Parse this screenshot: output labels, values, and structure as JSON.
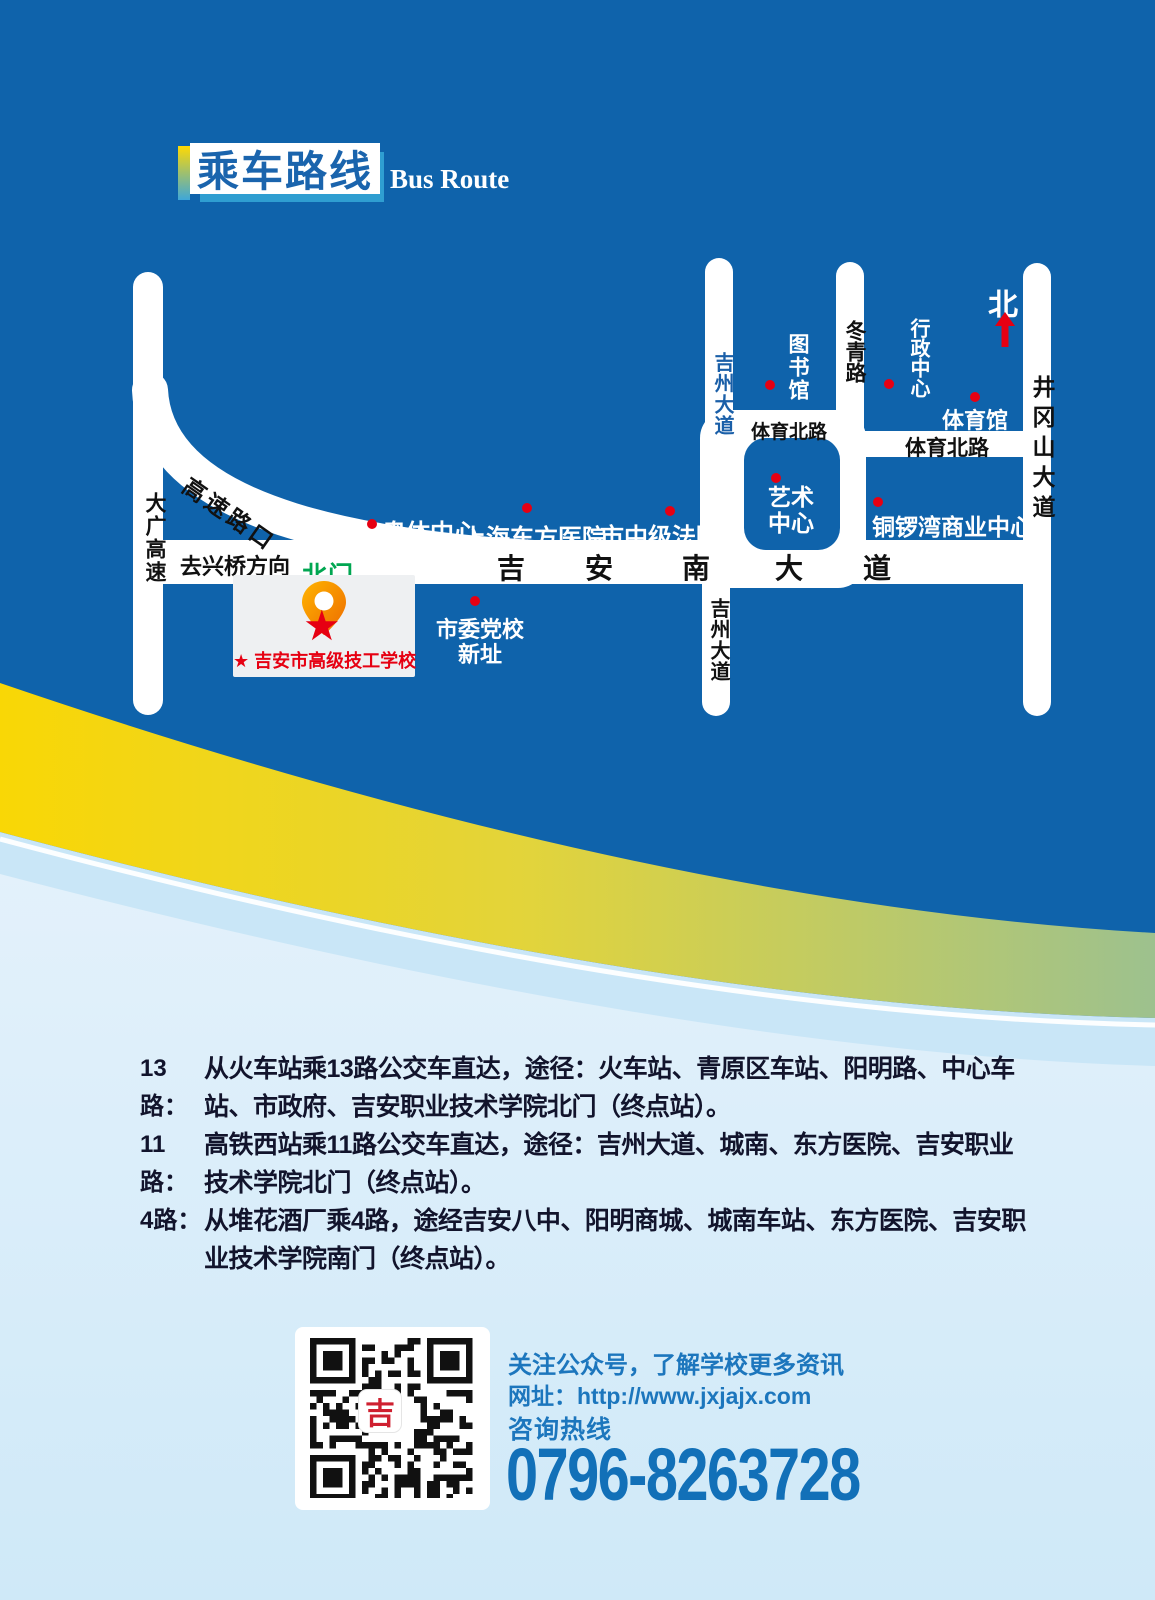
{
  "header": {
    "title": "乘车路线",
    "subtitle": "Bus Route"
  },
  "map": {
    "north_label": "北",
    "roads": {
      "daguang_expwy": "大广高速",
      "expwy_exit": "高速路口",
      "to_xingqiao": "去兴桥方向",
      "north_gate": "北门",
      "jian_south_ave_chars": [
        "吉",
        "安",
        "南",
        "大",
        "道"
      ],
      "jizhou_ave_north": "吉州大道",
      "jizhou_ave_south": "吉州大道",
      "dongqing_rd": "冬青路",
      "tiyu_north_rd_west": "体育北路",
      "tiyu_north_rd_east": "体育北路",
      "jinggangshan_ave": "井冈山大道"
    },
    "landmarks": {
      "aoti_center": "奥体中心",
      "shanghai_dongfang_hospital": "上海东方医院",
      "intermediate_court": "市中级法院",
      "library": "图书馆",
      "art_center": "艺术中心",
      "admin_center": "行政中心",
      "gymnasium": "体育馆",
      "tongluowan_mall": "铜锣湾商业中心",
      "party_school_line1": "市委党校",
      "party_school_line2": "新址"
    },
    "school_label": "★ 吉安市高级技工学校"
  },
  "routes": [
    {
      "no": "13路：",
      "desc": "从火车站乘13路公交车直达，途径：火车站、青原区车站、阳明路、中心车站、市政府、吉安职业技术学院北门（终点站）。"
    },
    {
      "no": "11路：",
      "desc": "高铁西站乘11路公交车直达，途径：吉州大道、城南、东方医院、吉安职业技术学院北门（终点站）。"
    },
    {
      "no": "4路：",
      "desc": "从堆花酒厂乘4路，途经吉安八中、阳明商城、城南车站、东方医院、吉安职业技术学院南门（终点站）。"
    }
  ],
  "contact": {
    "follow": "关注公众号，了解学校更多资讯",
    "website_label": "网址：",
    "website": "http://www.jxjajx.com",
    "hotline_label": "咨询热线",
    "phone": "0796-8263728",
    "qr_logo": "吉"
  },
  "colors": {
    "primary_blue": "#0f63ab",
    "accent_yellow": "#f9d705",
    "accent_green": "#9dc18e",
    "light_blue": "#c9e6f7",
    "landmark_red": "#e60012",
    "gate_green": "#00a651",
    "contact_blue": "#1c76bd"
  }
}
